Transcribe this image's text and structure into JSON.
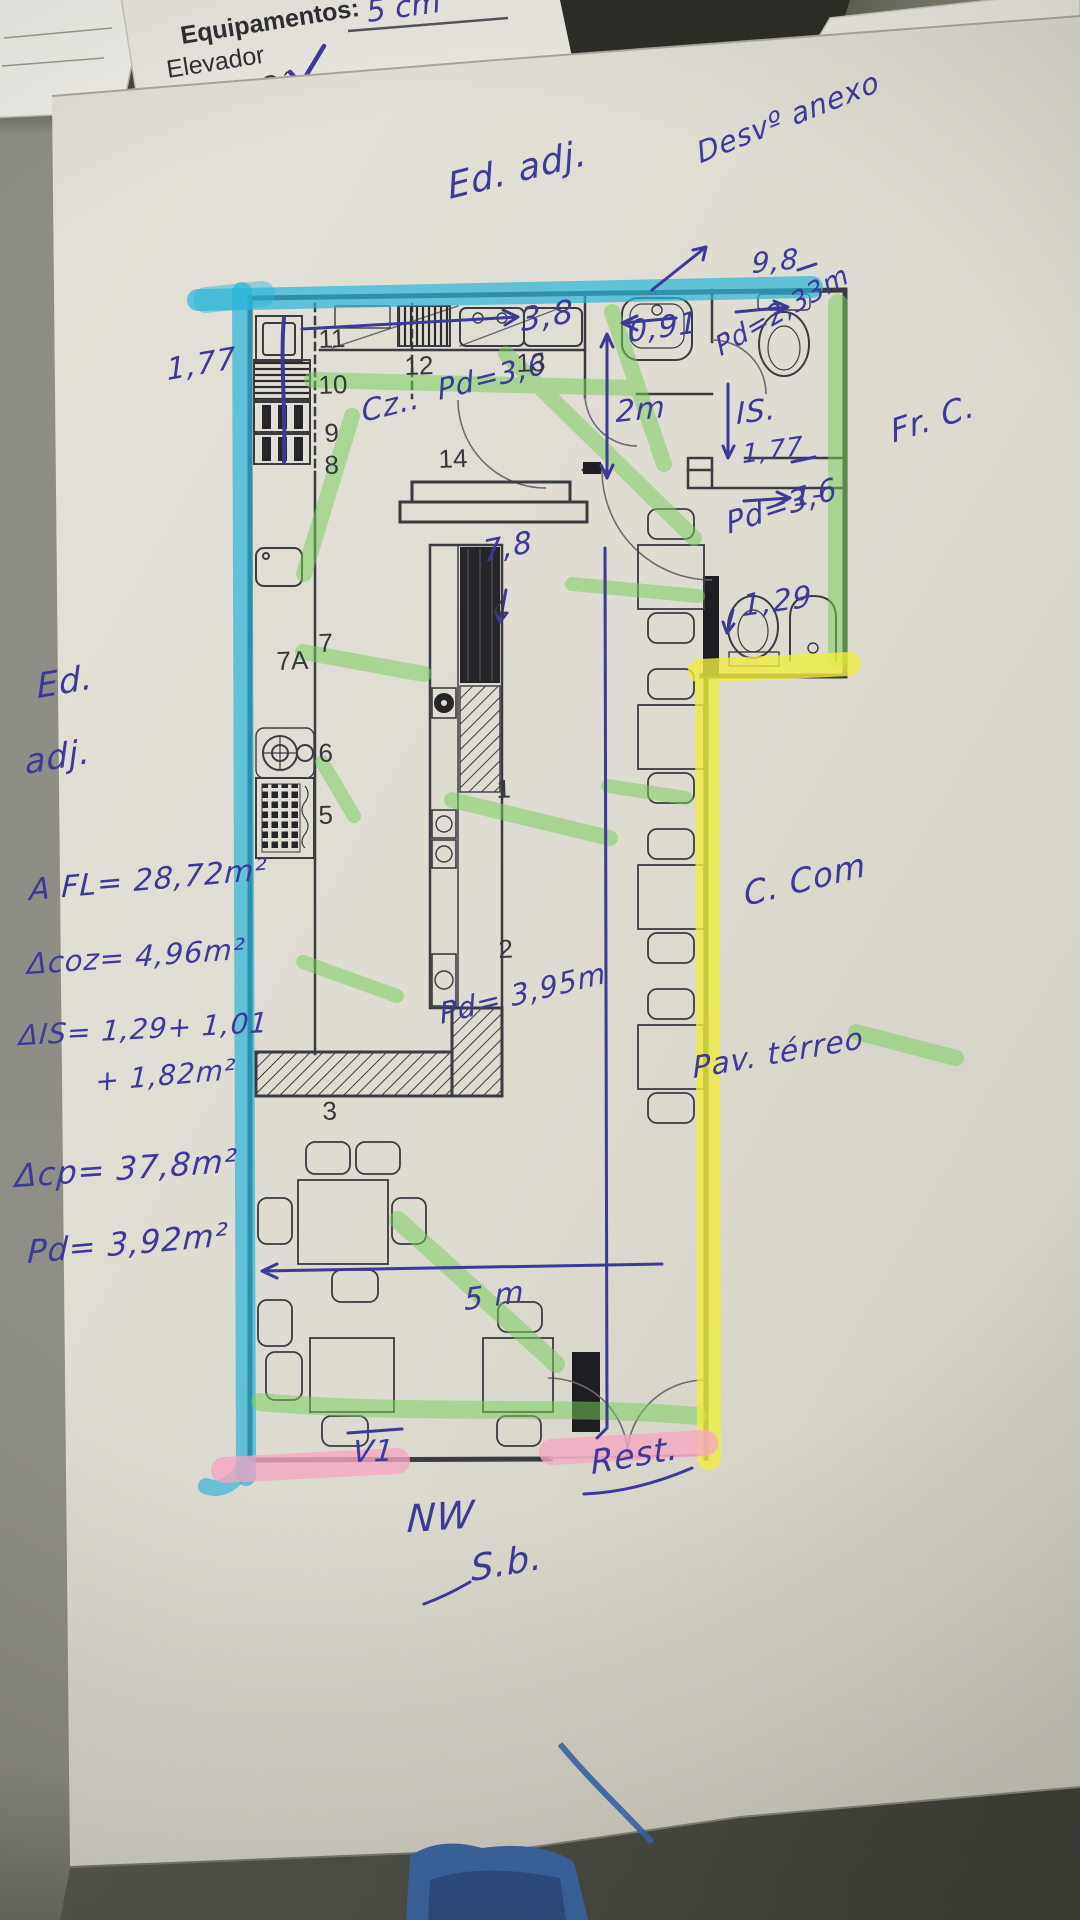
{
  "papers": {
    "top_left": {
      "handwritten_fragment": "5 cm",
      "title": "Equipamentos:",
      "line1": "Elevador",
      "line2": "Rede de Gá"
    },
    "top_right": {
      "printed": "teriores CC / Ed. adj. Etc.:",
      "field_label": "ra:",
      "field_value": "15cm"
    }
  },
  "colors": {
    "highlight_cyan": "#2ab5d8",
    "highlight_green": "#77cf5a",
    "highlight_yellow": "#efed3e",
    "highlight_pink": "#f6a6c3",
    "ink_blue": "#3b3a99",
    "plan_ink": "#3b3b42",
    "paper": "#dfdcd2"
  },
  "plan_labels": [
    {
      "n": "11",
      "x": 318,
      "y": 326
    },
    {
      "n": "12",
      "x": 404,
      "y": 353
    },
    {
      "n": "13",
      "x": 516,
      "y": 350
    },
    {
      "n": "10",
      "x": 318,
      "y": 372
    },
    {
      "n": "9",
      "x": 324,
      "y": 420
    },
    {
      "n": "8",
      "x": 324,
      "y": 452
    },
    {
      "n": "14",
      "x": 438,
      "y": 446
    },
    {
      "n": "7A",
      "x": 276,
      "y": 648
    },
    {
      "n": "7",
      "x": 318,
      "y": 630
    },
    {
      "n": "6",
      "x": 318,
      "y": 740
    },
    {
      "n": "5",
      "x": 318,
      "y": 802
    },
    {
      "n": "4",
      "x": 492,
      "y": 596
    },
    {
      "n": "1",
      "x": 496,
      "y": 776
    },
    {
      "n": "2",
      "x": 498,
      "y": 936
    },
    {
      "n": "3",
      "x": 322,
      "y": 1098
    }
  ],
  "annotations": [
    {
      "id": "ed-adj-top",
      "text": "Ed. adj.",
      "x": 446,
      "y": 170,
      "r": -14,
      "s": 36
    },
    {
      "id": "desvao-anexo",
      "text": "Desvº anexo",
      "x": 694,
      "y": 140,
      "r": -22,
      "s": 29
    },
    {
      "id": "dim-9-8",
      "text": "9,8",
      "x": 752,
      "y": 250,
      "r": -6,
      "s": 28
    },
    {
      "id": "dim-1-77-left",
      "text": "1,77",
      "x": 166,
      "y": 356,
      "r": -10,
      "s": 30
    },
    {
      "id": "cz",
      "text": "Cz..",
      "x": 360,
      "y": 398,
      "r": -14,
      "s": 30
    },
    {
      "id": "pd-3-6-kitchen",
      "text": "Pd=3,6",
      "x": 436,
      "y": 376,
      "r": -14,
      "s": 29
    },
    {
      "id": "dim-3-8",
      "text": "3,8",
      "x": 520,
      "y": 304,
      "r": -10,
      "s": 32
    },
    {
      "id": "dim-0-91",
      "text": "0,91",
      "x": 628,
      "y": 318,
      "r": -8,
      "s": 30
    },
    {
      "id": "pd-2-33",
      "text": "Pd=2,33m",
      "x": 712,
      "y": 336,
      "r": -30,
      "s": 27
    },
    {
      "id": "dim-2m",
      "text": "2m",
      "x": 616,
      "y": 398,
      "r": -6,
      "s": 30
    },
    {
      "id": "is-label",
      "text": "IS.",
      "x": 736,
      "y": 400,
      "r": -8,
      "s": 30
    },
    {
      "id": "dim-1-77-is",
      "text": "1,77",
      "x": 742,
      "y": 442,
      "r": -8,
      "s": 26
    },
    {
      "id": "dim-1",
      "text": "1-",
      "x": 794,
      "y": 484,
      "r": -6,
      "s": 27
    },
    {
      "id": "pd-3-6-wc",
      "text": "Pd=3,6",
      "x": 724,
      "y": 510,
      "r": -18,
      "s": 30
    },
    {
      "id": "dim-1-29",
      "text": "1,29",
      "x": 742,
      "y": 592,
      "r": -8,
      "s": 30
    },
    {
      "id": "fr-c",
      "text": "Fr. C.",
      "x": 888,
      "y": 416,
      "r": -18,
      "s": 32
    },
    {
      "id": "dim-7-8",
      "text": "7,8",
      "x": 482,
      "y": 538,
      "r": -12,
      "s": 30
    },
    {
      "id": "ed-left",
      "text": "Ed.",
      "x": 36,
      "y": 670,
      "r": -10,
      "s": 34
    },
    {
      "id": "adj-left",
      "text": "adj.",
      "x": 24,
      "y": 746,
      "r": -10,
      "s": 34
    },
    {
      "id": "area-fl",
      "text": "A FL= 28,72m²",
      "x": 30,
      "y": 876,
      "r": -5,
      "s": 30
    },
    {
      "id": "area-coz",
      "text": "Δcoz= 4,96m²",
      "x": 28,
      "y": 950,
      "r": -4,
      "s": 29
    },
    {
      "id": "area-is",
      "text": "ΔIS= 1,29+ 1,01",
      "x": 20,
      "y": 1022,
      "r": -3,
      "s": 28
    },
    {
      "id": "area-is-2",
      "text": "+ 1,82m²",
      "x": 96,
      "y": 1068,
      "r": -5,
      "s": 28
    },
    {
      "id": "area-cp",
      "text": "Δcp= 37,8m²",
      "x": 16,
      "y": 1160,
      "r": -4,
      "s": 32
    },
    {
      "id": "pd-3-92",
      "text": "Pd= 3,92m²",
      "x": 28,
      "y": 1236,
      "r": -5,
      "s": 32
    },
    {
      "id": "c-com",
      "text": "C. Com",
      "x": 742,
      "y": 878,
      "r": -14,
      "s": 33
    },
    {
      "id": "pav-terreo",
      "text": "Pav. térreo",
      "x": 692,
      "y": 1054,
      "r": -10,
      "s": 30
    },
    {
      "id": "pd-3-95",
      "text": "Pd= 3,95m",
      "x": 438,
      "y": 1000,
      "r": -14,
      "s": 29
    },
    {
      "id": "dim-5m",
      "text": "5 m",
      "x": 464,
      "y": 1286,
      "r": -8,
      "s": 30
    },
    {
      "id": "v1",
      "text": "V1",
      "x": 354,
      "y": 1438,
      "r": -2,
      "s": 30
    },
    {
      "id": "rest",
      "text": "Rest.",
      "x": 590,
      "y": 1446,
      "r": -10,
      "s": 33
    },
    {
      "id": "nw",
      "text": "NW",
      "x": 408,
      "y": 1500,
      "r": -4,
      "s": 38
    },
    {
      "id": "sb",
      "text": "S.b.",
      "x": 470,
      "y": 1552,
      "r": -10,
      "s": 36
    }
  ]
}
